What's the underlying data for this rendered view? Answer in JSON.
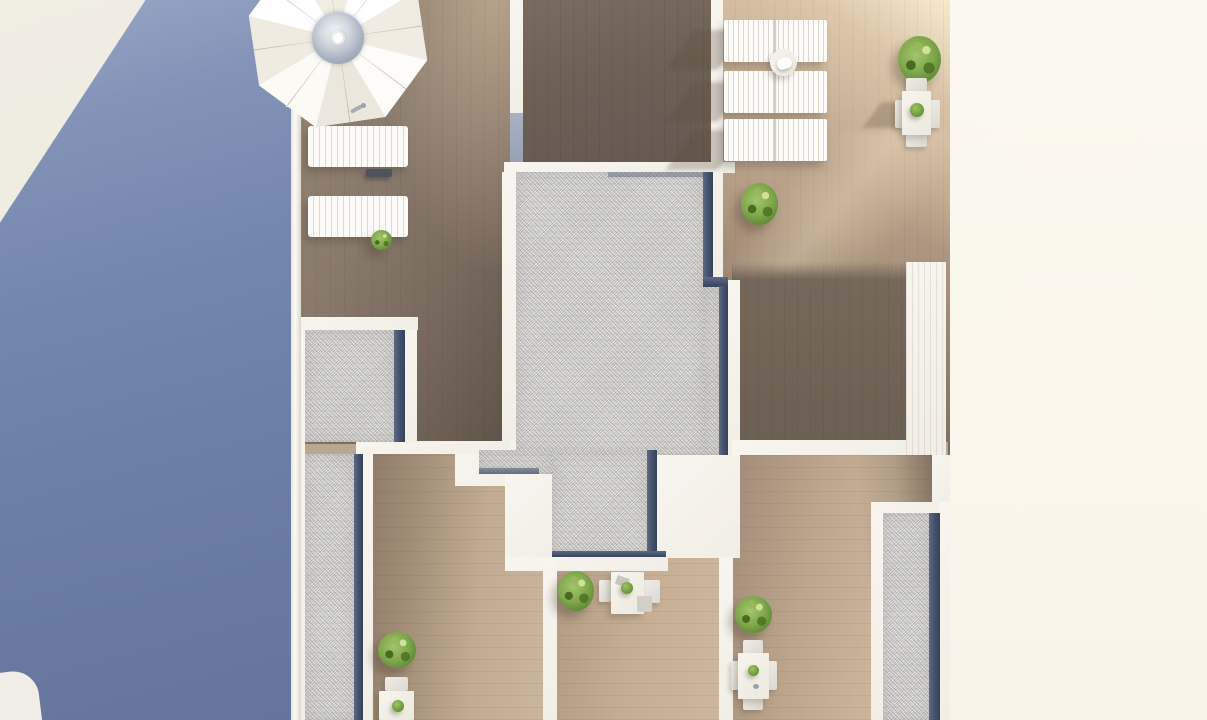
{
  "scene": {
    "label": "Aerial 3D architectural render of a rooftop terrace floor plan",
    "areas": {
      "facade": {
        "label": "Blue shaded building facade strip with sunlit corner reflection"
      },
      "margin": {
        "label": "Empty cream page margin"
      },
      "terrace_left": {
        "label": "Wooden deck terrace with parasol and two sun loungers"
      },
      "room_top_center": {
        "label": "Dark wooden deck section at top center"
      },
      "terrace_sunlit": {
        "label": "Sunlit wooden terrace with three rows of paired sun loungers"
      },
      "room_shaded": {
        "label": "Shaded wooden deck section on the right"
      },
      "gravel_main": {
        "label": "Central gravel roof section with dark drainage edge"
      },
      "gravel_left": {
        "label": "Left gravel roof strip"
      },
      "gravel_right": {
        "label": "Right gravel roof strip"
      },
      "room_a": {
        "label": "Lower-left wooden terrace with shrub and dining set"
      },
      "room_b": {
        "label": "Lower-middle wooden terrace with shrub and dining table"
      },
      "room_c": {
        "label": "Lower-right wooden terrace with shrub and dining table"
      }
    },
    "furniture": {
      "parasol": {
        "label": "White octagonal parasol with glass center dome"
      },
      "loungers_left": {
        "label": "Two white slatted sun loungers",
        "count": 2
      },
      "lounger_rows": {
        "label": "Rows of paired white sun loungers",
        "count": 3
      },
      "side_table": {
        "label": "Round side table with white towels"
      },
      "dining_terrace": {
        "label": "Terrace dining table with two chairs and potted plant"
      },
      "dining_a": {
        "label": "Dining table with chair and potted plant"
      },
      "dining_b": {
        "label": "Dining table with two chairs and potted plant"
      },
      "dining_c": {
        "label": "Dining table with two chairs and potted plant"
      },
      "shrubs": {
        "label": "Round green shrubs",
        "count": 6
      }
    }
  },
  "palette": {
    "blue_top": "#9aa8c6",
    "blue_mid": "#7487ae",
    "blue_bottom": "#64759b",
    "sun_patch": "#f4f0e4",
    "cream": "#fbf8f0",
    "divider": "#5d5c55",
    "wall": "#f1eee5",
    "wall_shadow": "#a9b2c3",
    "gravel": "#c7c6c3",
    "roof_edge": "#42506b",
    "wood_terrace": "#84756a",
    "wood_dark": "#6e6055",
    "wood_sunlit": "#c6ae94",
    "wood_light": "#ccb79d",
    "shrub": "#7fa74b",
    "shrub_dark": "#54762e",
    "furniture_white": "#f6f4ed",
    "slat": "#dcd9cf",
    "dome": "#8d98aa"
  }
}
